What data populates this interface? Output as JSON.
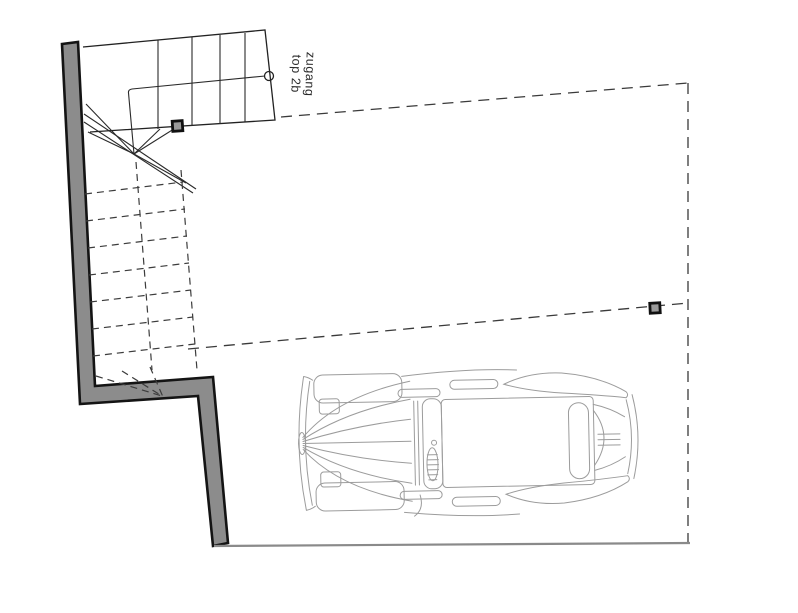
{
  "plan": {
    "title": "floor-plan-parking-level",
    "label": {
      "line1": "zugang",
      "line2": "top 2b"
    },
    "symbols": {
      "walking_line_start": "circle-marker",
      "structural_post": "square-post-marker",
      "stairs_above": "dashed-lines",
      "stair_break": "double-diagonal-line"
    },
    "colors": {
      "wall_fill": "#8c8c8c",
      "wall_outline": "#141414",
      "stair_line": "#222222",
      "dashed_line": "#3c3c3c",
      "boundary_line": "#8a8a8a",
      "car_line": "#9c9c9c",
      "label_text": "#2a2a2a",
      "background": "#ffffff"
    }
  }
}
